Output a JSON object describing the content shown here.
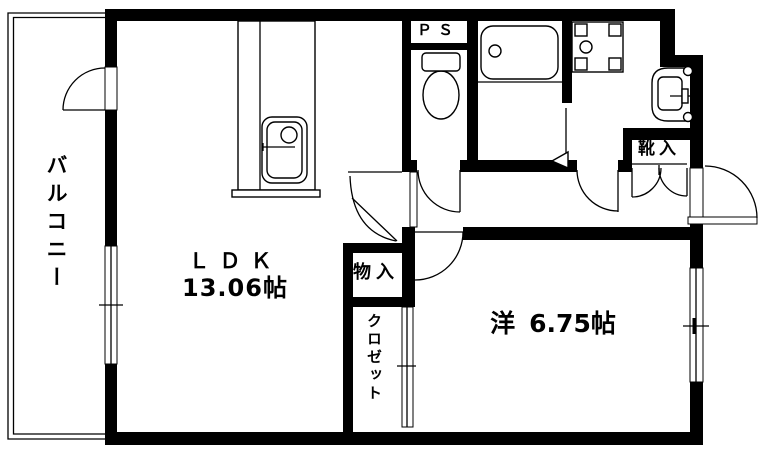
{
  "floorplan": {
    "title": "apartment-floorplan-1ldk",
    "colors": {
      "wall": "#000000",
      "background": "#ffffff"
    },
    "rooms": {
      "balcony": {
        "label": "バルコニー"
      },
      "ldk": {
        "label": "ＬＤＫ",
        "size": "13.06帖"
      },
      "western_room": {
        "label": "洋",
        "size": "6.75帖"
      },
      "pipe_space": {
        "label": "ＰＳ"
      },
      "shoe_cabinet": {
        "label": "靴入"
      },
      "storage": {
        "label": "物入"
      },
      "closet": {
        "label": "クロゼット"
      }
    },
    "fixtures": [
      {
        "name": "kitchen-sink-icon"
      },
      {
        "name": "toilet-icon"
      },
      {
        "name": "bathtub-icon"
      },
      {
        "name": "washing-machine-pan-icon"
      },
      {
        "name": "wash-basin-icon"
      }
    ]
  }
}
